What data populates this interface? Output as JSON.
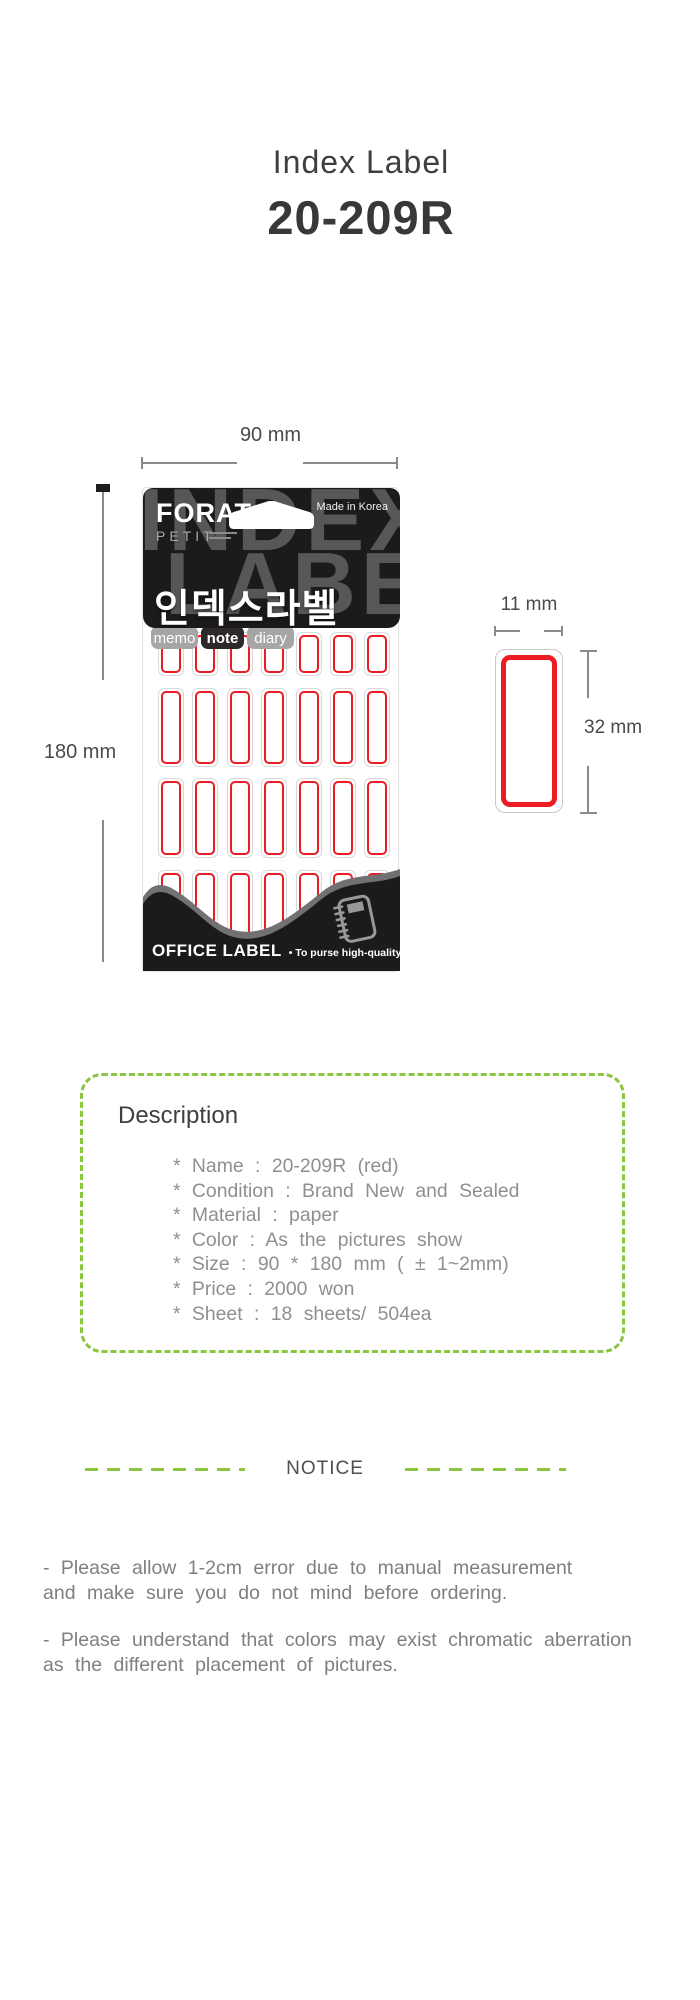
{
  "header": {
    "title": "Index Label",
    "model": "20-209R"
  },
  "figure": {
    "dim_width": "90 mm",
    "dim_height": "180 mm",
    "package": {
      "brand": "FORAT",
      "brand_sub": "PETIT",
      "made_in": "Made in Korea",
      "ghost": [
        "INDEX",
        "LABEL"
      ],
      "korean_title": "인덱스라벨",
      "tabs": [
        {
          "label": "memo",
          "variant": "gray"
        },
        {
          "label": "note",
          "variant": "dark"
        },
        {
          "label": "diary",
          "variant": "gray"
        }
      ],
      "footer_brand": "OFFICE LABEL",
      "footer_tagline": "• To purse high-quality labels.",
      "label_grid": {
        "columns": 7,
        "col_start": 15,
        "col_pitch": 34.4,
        "col_width": 26,
        "rows": [
          {
            "top": 144,
            "height": 44
          },
          {
            "top": 200,
            "height": 79
          },
          {
            "top": 290,
            "height": 80
          },
          {
            "top": 382,
            "height": 80
          }
        ]
      }
    },
    "single_label": {
      "dim_width": "11 mm",
      "dim_height": "32 mm"
    }
  },
  "description": {
    "heading": "Description",
    "items": [
      "* Name : 20-209R (red)",
      "* Condition : Brand New and Sealed",
      "* Material : paper",
      "* Color : As the pictures show",
      "* Size : 90 * 180 mm ( ± 1~2mm)",
      "* Price : 2000 won",
      "* Sheet : 18 sheets/ 504ea"
    ]
  },
  "notice": {
    "heading": "NOTICE",
    "paragraphs": [
      [
        "- Please allow 1-2cm error due to manual measurement",
        "and make sure you do not mind before ordering."
      ],
      [
        "- Please understand that colors may exist chromatic aberration",
        "as the different placement of pictures."
      ]
    ]
  },
  "colors": {
    "accent_red": "#ec1c24",
    "accent_green": "#8cc63e",
    "package_black": "#1c1a1b",
    "ghost_gray": "#57575a",
    "tab_gray": "#a7a5a6",
    "body_text_gray": "#8f8f8f"
  }
}
